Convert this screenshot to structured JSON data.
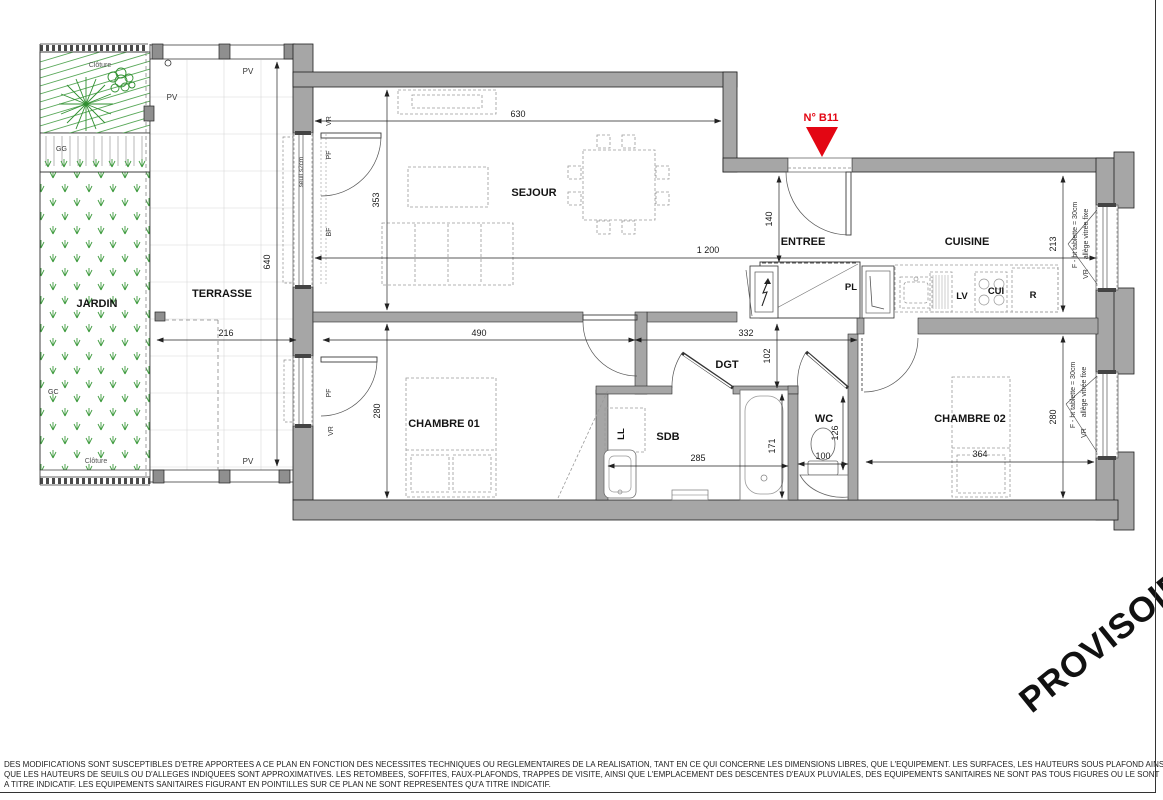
{
  "plan": {
    "rooms": {
      "jardin": "JARDIN",
      "terrasse": "TERRASSE",
      "sejour": "SEJOUR",
      "entree": "ENTREE",
      "cuisine": "CUISINE",
      "chambre1": "CHAMBRE 01",
      "sdb": "SDB",
      "dgt": "DGT",
      "wc": "WC",
      "chambre2": "CHAMBRE 02"
    },
    "unit_marker": "N° B11",
    "dims": {
      "d630": "630",
      "d353": "353",
      "d1200": "1 200",
      "d140": "140",
      "d213": "213",
      "d216": "216",
      "d640": "640",
      "d490": "490",
      "d332": "332",
      "d102": "102",
      "d280a": "280",
      "d280b": "280",
      "d285": "285",
      "d171": "171",
      "d126": "126",
      "d100": "100",
      "d364": "364"
    },
    "fixtures": {
      "pl": "PL",
      "lv": "LV",
      "cui": "CUI",
      "r": "R",
      "ll": "LL"
    },
    "window_labels": {
      "vr": "VR",
      "pf": "PF",
      "bf": "BF",
      "pv": "PV",
      "seuil": "seuil s2cm",
      "f_line": "F - ht tablette = 30cm",
      "allege_line": "allège vitrée fixe"
    },
    "site_labels": {
      "cloture": "Clôture",
      "gg": "GG",
      "gc": "GC"
    },
    "watermark": "PROVISOIRE",
    "disclaimer": {
      "line1": "DES MODIFICATIONS SONT SUSCEPTIBLES D'ETRE APPORTEES A CE PLAN EN FONCTION DES NECESSITES TECHNIQUES OU REGLEMENTAIRES DE LA REALISATION, TANT EN CE QUI CONCERNE LES DIMENSIONS LIBRES, QUE L'EQUIPEMENT. LES SURFACES, LES HAUTEURS SOUS PLAFOND AINSI",
      "line2": "QUE LES HAUTEURS DE SEUILS OU D'ALLEGES INDIQUEES SONT APPROXIMATIVES. LES RETOMBEES, SOFFITES, FAUX-PLAFONDS, TRAPPES DE VISITE, AINSI QUE L'EMPLACEMENT DES DESCENTES D'EAUX PLUVIALES, DES EQUIPEMENTS SANITAIRES NE SONT PAS TOUS FIGURES OU LE SONT",
      "line3": "A TITRE INDICATIF. LES EQUIPEMENTS SANITAIRES FIGURANT EN POINTILLES SUR CE PLAN NE SONT REPRESENTES QU'A TITRE INDICATIF."
    },
    "colors": {
      "wall": "#a6a6a6",
      "garden_green": "#3f9b3f",
      "marker_red": "#e30613"
    }
  }
}
